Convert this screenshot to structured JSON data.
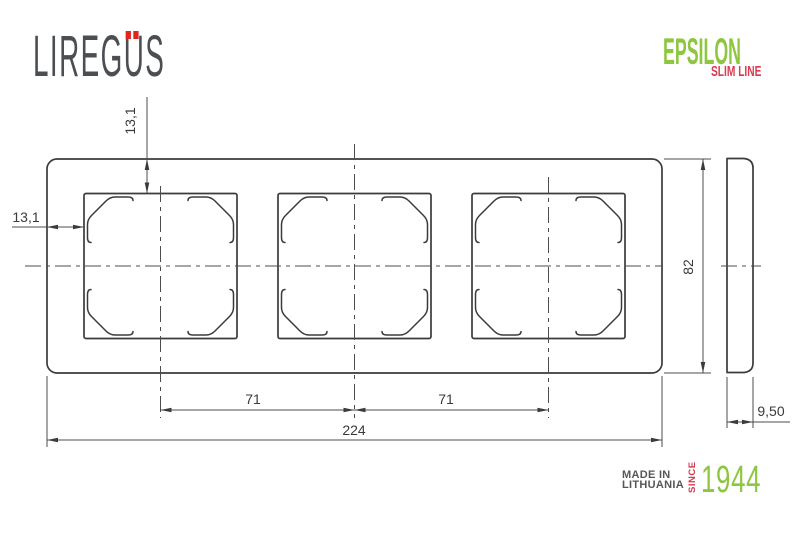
{
  "brand": {
    "logo_left": "LIREG",
    "logo_u": "U",
    "logo_right": "S",
    "series_name": "EPSILON",
    "series_sub": "SLIM LINE"
  },
  "drawing": {
    "dim_top_inset": "13,1",
    "dim_left_inset": "13,1",
    "dim_spacing_left": "71",
    "dim_spacing_right": "71",
    "dim_total_width": "224",
    "dim_total_height": "82",
    "dim_depth": "9,50"
  },
  "footer": {
    "made_in_line1": "MADE IN",
    "made_in_line2": "LITHUANIA",
    "since_label": "SINCE",
    "year": "1944"
  },
  "colors": {
    "brand_green": "#8dc63f",
    "brand_red": "#dc3a50",
    "logo_gray": "#4b4f54",
    "umlaut_dot_red": "#e1251c",
    "drawing_line": "#3b3b3b"
  }
}
